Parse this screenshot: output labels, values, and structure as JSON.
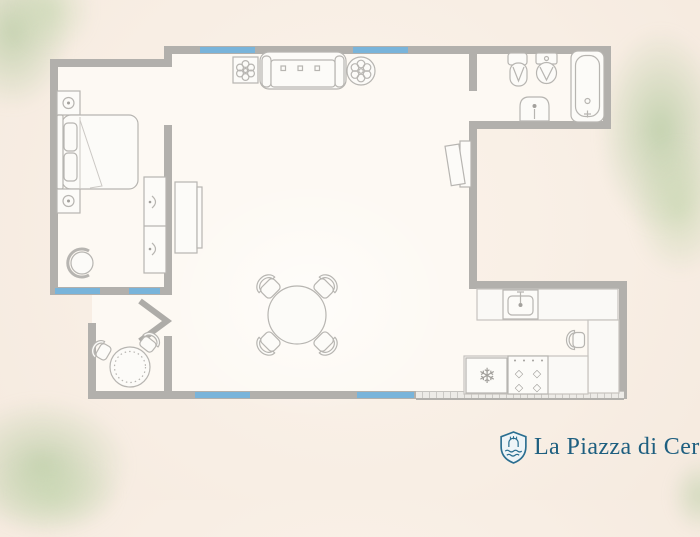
{
  "canvas": {
    "width": 700,
    "height": 500
  },
  "palette": {
    "background": "#f8eee4",
    "floor": "#fdf9f3",
    "wall": "#b2b0ac",
    "window": "#79b4da",
    "furniture_outline": "#b7b5b1",
    "foliage": "#b4c796",
    "brand": "#1e5f80"
  },
  "floorplan": {
    "type": "apartment-floor-plan",
    "rooms": [
      {
        "name": "bedroom",
        "furniture": [
          "double-bed",
          "nightstand-with-lamp",
          "nightstand-with-lamp",
          "armchair",
          "chest-of-drawers"
        ]
      },
      {
        "name": "living-room",
        "furniture": [
          "sofa",
          "potted-plant-square",
          "potted-plant-round",
          "sideboard",
          "wall-mounted-tv",
          "round-dining-table",
          "dining-chair",
          "dining-chair",
          "dining-chair",
          "dining-chair"
        ]
      },
      {
        "name": "bathroom",
        "furniture": [
          "bidet",
          "toilet",
          "washbasin",
          "bathtub"
        ]
      },
      {
        "name": "kitchen",
        "furniture": [
          "counter-with-sink",
          "side-counter",
          "refrigerator",
          "stove",
          "bar-chair"
        ]
      },
      {
        "name": "balcony",
        "furniture": [
          "door-swing",
          "bistro-table",
          "bistro-chair",
          "bistro-chair"
        ]
      }
    ],
    "icons": {
      "refrigerator": "❄",
      "burner": "◇"
    },
    "window_segments": 6
  },
  "logo": {
    "icon": "shield-icon",
    "text": "La Piazza di Cerr"
  }
}
